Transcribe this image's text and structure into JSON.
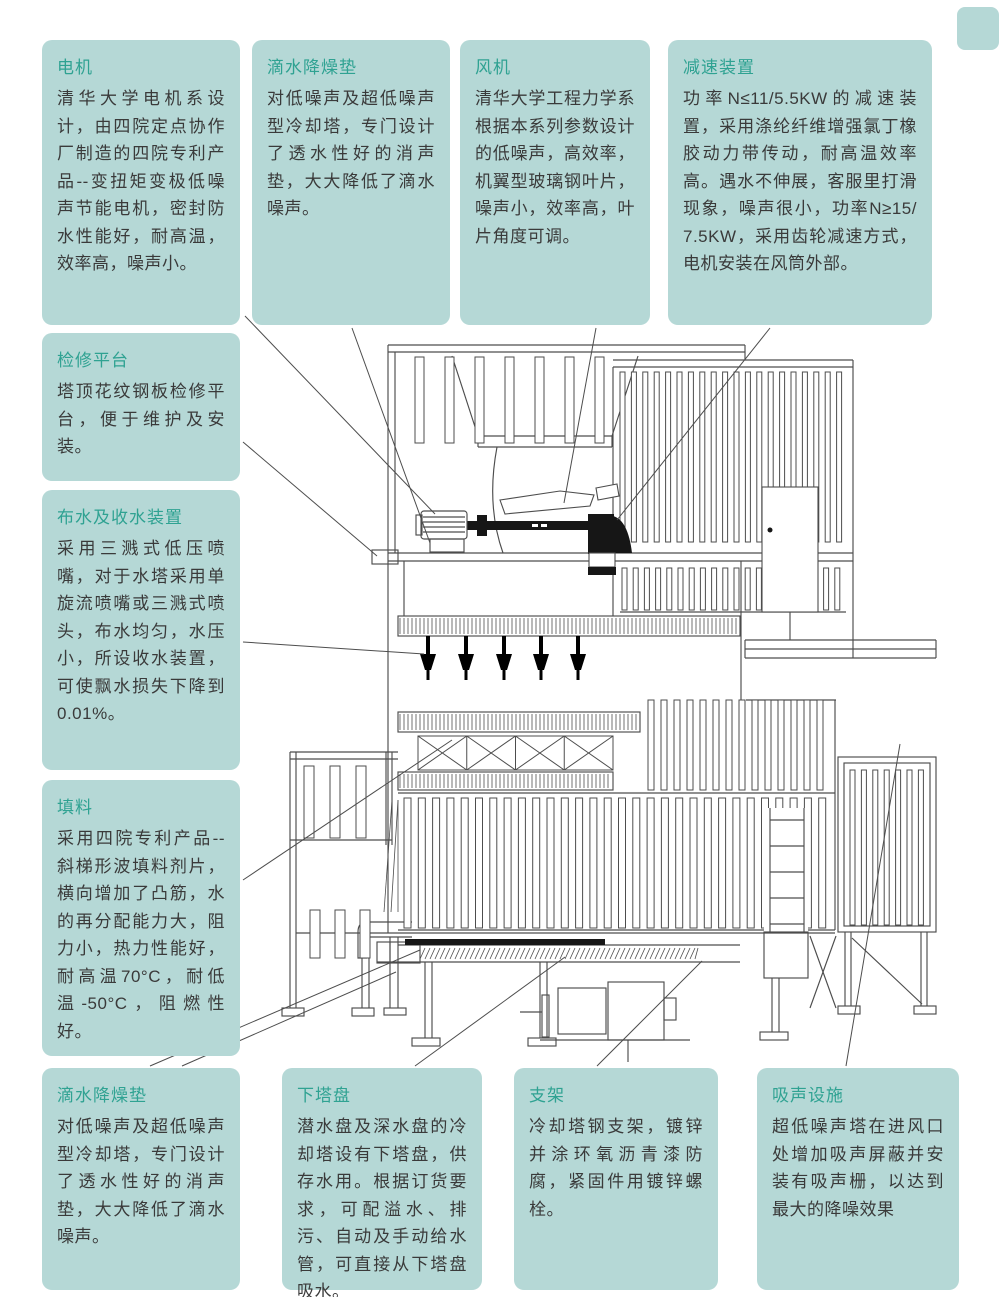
{
  "colors": {
    "box_fill": "#b5d8d6",
    "title_text": "#2fa292",
    "body_text": "#3a3a3a",
    "line": "#4d4d4d"
  },
  "callouts": [
    {
      "id": "motor",
      "title": "电机",
      "body": "清华大学电机系设计，由四院定点协作厂制造的四院专利产品--变扭矩变极低噪声节能电机，密封防水性能好，耐高温，效率高，噪声小。"
    },
    {
      "id": "drip-pad-top",
      "title": "滴水降燥垫",
      "body": "对低噪声及超低噪声型冷却塔，专门设计了透水性好的消声垫，大大降低了滴水噪声。"
    },
    {
      "id": "fan",
      "title": "风机",
      "body": "清华大学工程力学系根据本系列参数设计的低噪声，高效率，机翼型玻璃钢叶片，噪声小，效率高，叶片角度可调。"
    },
    {
      "id": "reducer",
      "title": "减速装置",
      "body": "功率N≤11/5.5KW的减速装置，采用涤纶纤维增强氯丁橡胶动力带传动，耐高温效率高。遇水不伸展，客服里打滑现象，噪声很小，功率N≥15/7.5KW，采用齿轮减速方式，电机安装在风筒外部。"
    },
    {
      "id": "platform",
      "title": "检修平台",
      "body": "塔顶花纹钢板检修平台，便于维护及安装。"
    },
    {
      "id": "water-device",
      "title": "布水及收水装置",
      "body": "采用三溅式低压喷嘴，对于水塔采用单旋流喷嘴或三溅式喷头，布水均匀，水压小，所设收水装置，可使飘水损失下降到0.01%。"
    },
    {
      "id": "fill-media",
      "title": "填料",
      "body": "采用四院专利产品--斜梯形波填料剂片，横向增加了凸筋，水的再分配能力大，阻力小，热力性能好，耐高温70°C，耐低温-50°C，阻燃性好。"
    },
    {
      "id": "drip-pad-bottom",
      "title": "滴水降燥垫",
      "body": "对低噪声及超低噪声型冷却塔，专门设计了透水性好的消声垫，大大降低了滴水噪声。"
    },
    {
      "id": "lower-basin",
      "title": "下塔盘",
      "body": "潜水盘及深水盘的冷却塔设有下塔盘，供存水用。根据订货要求，可配溢水、排污、自动及手动给水管，可直接从下塔盘吸水。"
    },
    {
      "id": "support",
      "title": "支架",
      "body": "冷却塔钢支架，镀锌并涂环氧沥青漆防腐，紧固件用镀锌螺栓。"
    },
    {
      "id": "sound-absorber",
      "title": "吸声设施",
      "body": "超低噪声塔在进风口处增加吸声屏蔽并安装有吸声栅，以达到最大的降噪效果"
    }
  ]
}
